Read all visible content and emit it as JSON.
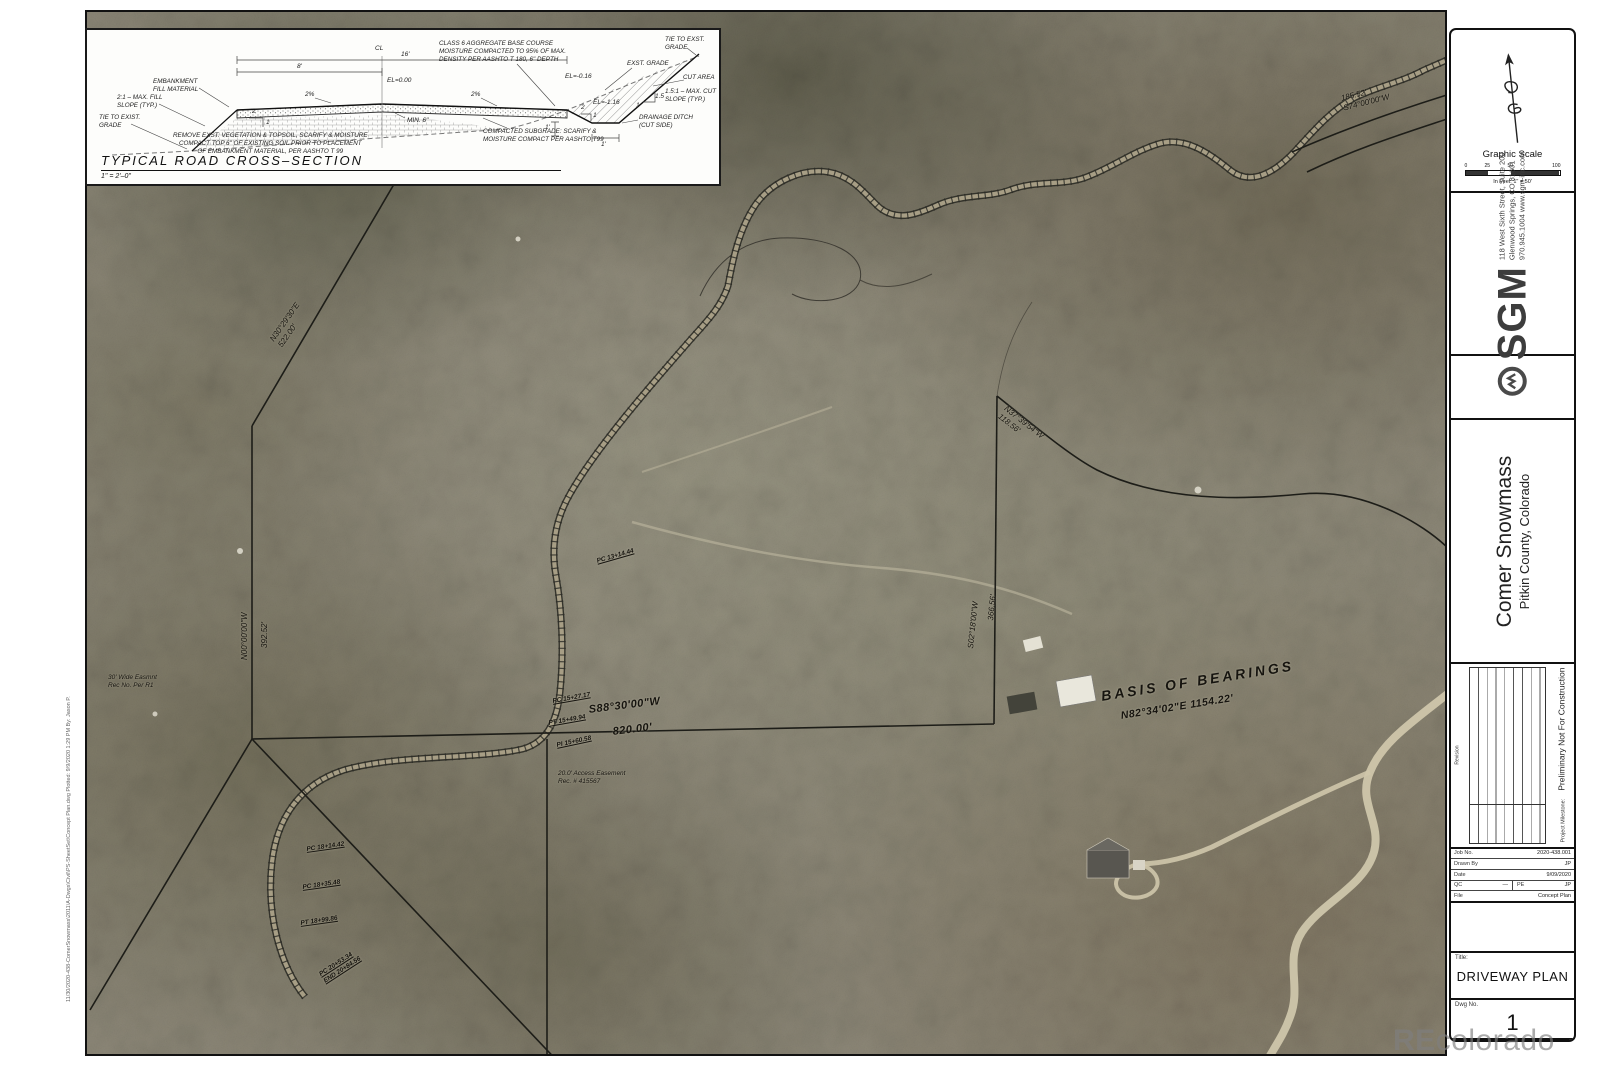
{
  "sheet": {
    "plot_stamp": "11/30/2020-438-ComerSnowmass\\2011\\A-Dwgs\\Civil\\PS-SheetSet\\Concept Plan.dwg   Plotted: 9/9/2020 1:29 PM   By: Jason P.",
    "watermark_re": "RE",
    "watermark_rest": "colorado"
  },
  "cross_section": {
    "title": "TYPICAL ROAD CROSS–SECTION",
    "scale": "1\" = 2'–0\"",
    "notes": {
      "embankment": "EMBANKMENT\nFILL MATERIAL",
      "fill_slope": "2:1 – MAX. FILL\nSLOPE (TYP.)",
      "tie_left": "TIE TO EXIST.\nGRADE",
      "remove_note": "REMOVE EXST. VEGETATION & TOPSOIL, SCARIFY & MOISTURE\nCOMPACT TOP 6\" OF EXISTING SOIL PRIOR TO PLACEMENT\nOF EMBANKMENT MATERIAL, PER AASHTO T 99",
      "class6": "CLASS 6 AGGREGATE BASE COURSE\nMOISTURE COMPACTED TO 95% OF MAX.\nDENSITY PER AASHTO T 180, 6\" DEPTH",
      "exst_grade": "EXST. GRADE",
      "tie_right": "TIE TO EXST.\nGRADE",
      "cut_area": "CUT AREA",
      "cut_slope": "1.5:1 – MAX. CUT\nSLOPE (TYP.)",
      "ditch": "DRAINAGE DITCH\n(CUT SIDE)",
      "subgrade": "COMPACTED SUBGRADE: SCARIFY &\nMOISTURE COMPACT PER AASHTO T99"
    },
    "dims": {
      "d8": "8'",
      "d16": "16'",
      "cl": "CL",
      "el0": "EL=0.00",
      "el016": "EL=-0.16",
      "el116": "EL=-1.16",
      "pct_l": "2%",
      "pct_r": "2%",
      "min6": "MIN. 6\"",
      "one_v": "1'",
      "one_h": "1'",
      "s2a": "2",
      "s1a": "1",
      "s2b": "2",
      "s1b": "1",
      "s15": "1.5",
      "s1c": "1"
    }
  },
  "map": {
    "basis_title": "BASIS  OF  BEARINGS",
    "basis_value": "N82°34'02\"E   1154.22'",
    "s88": "S88°30'00\"W",
    "s88_len": "820.00'",
    "n30": "N30°29'30\"E\n522.00'",
    "n00": "N00°00'00\"W",
    "n00_len": "392.52'",
    "s02": "S02°18'00\"W",
    "s02_len": "366.56'",
    "n37": "N37°39'54\"W\n118.56'",
    "s74": "185.52'\nS74°00'00\"W",
    "stations": [
      "PC 13+14.44",
      "PC 15+27.17",
      "PT 15+49.94",
      "PI 15+60.58",
      "PC 18+14.42",
      "PC 18+35.48",
      "PT 18+99.86",
      "PC 20+53.34\nEND 20+84.56"
    ],
    "easement_access": "20.0' Access Easement\nRec. # 415567",
    "easement_wide": "30' Wide Easmnt\nRec No. Per R1"
  },
  "titleblock": {
    "graphic_scale": {
      "title": "Graphic Scale",
      "ticks": [
        "0",
        "25",
        "50",
        "100"
      ],
      "units": "In Feet: 1\" = 50'"
    },
    "firm": {
      "name": "SGM",
      "address1": "118 West Sixth Street, Suite 200",
      "address2": "Glenwood Springs, CO 81601",
      "address3": "970.945.1004   www.sgm-inc.com"
    },
    "project": {
      "name": "Comer Snowmass",
      "location": "Pitkin County, Colorado"
    },
    "revision": {
      "side_label": "Revision",
      "date_label": "Date",
      "by_label": "By.",
      "milestone_label": "Project Milestone:",
      "milestone": "Preliminary Not For Construction"
    },
    "info": {
      "job_no_label": "Job No.",
      "job_no": "2020-438.001",
      "drawn_by_label": "Drawn By",
      "drawn_by": "JP",
      "date_label": "Date",
      "date": "9/09/2020",
      "qc_label": "QC",
      "qc": "—",
      "pe_label": "PE",
      "pe": "JP",
      "file_label": "File",
      "file": "Concept Plan"
    },
    "title_label": "Title:",
    "title": "DRIVEWAY PLAN",
    "dwg_label": "Dwg No.",
    "dwg_no": "1"
  }
}
